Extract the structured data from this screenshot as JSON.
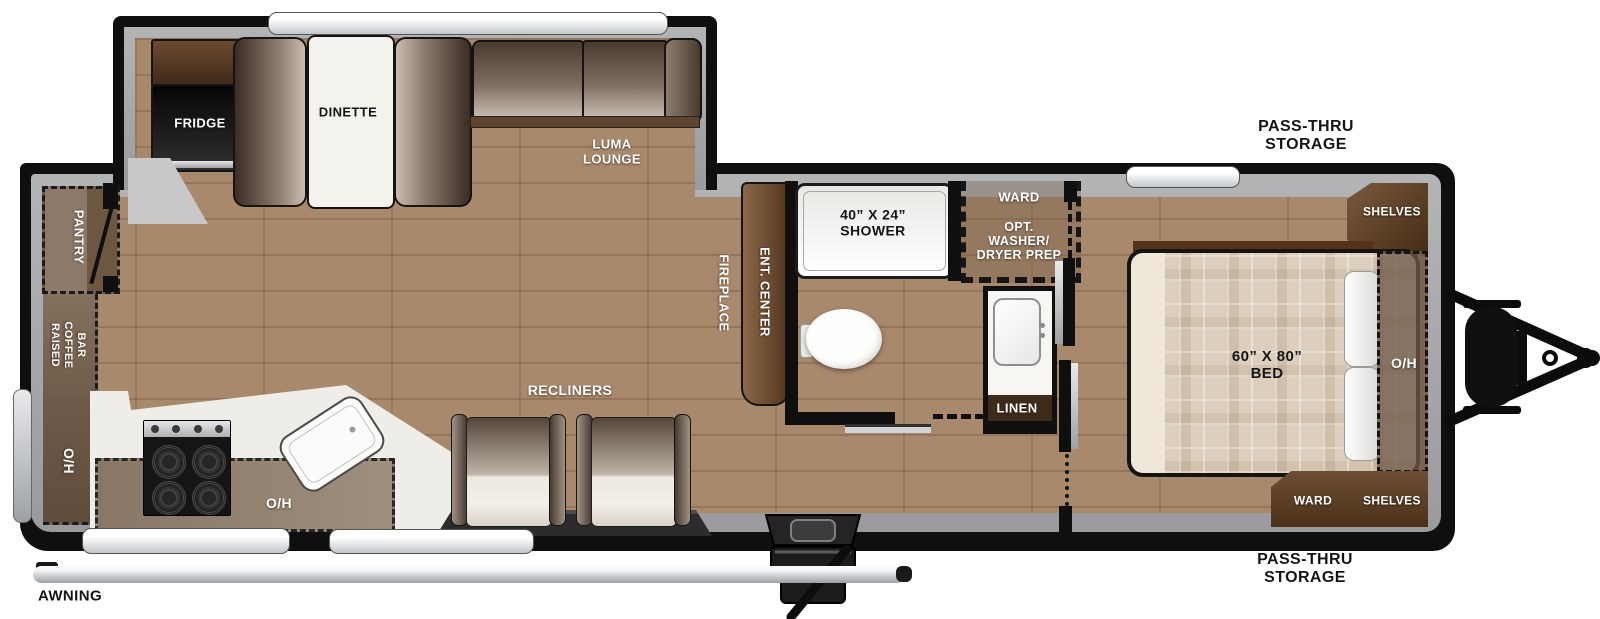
{
  "title": "Travel trailer floor plan",
  "colors": {
    "wall": "#0f0f0f",
    "floor_wood": "#a9896c",
    "wall_liner_gray": "#a7a9ac",
    "cabinet_brown": "#6e5740",
    "cabinet_dark_brown": "#4a3119",
    "counter_white": "#efede7",
    "overlay_brown": "#8b7360",
    "bed_plaid": "#dccfbd",
    "window_silver": "#c3c7ca"
  },
  "labels": {
    "fridge": "FRIDGE",
    "dinette": "DINETTE",
    "luma_line1": "LUMA",
    "luma_line2": "LOUNGE",
    "pantry": "PANTRY",
    "coffee_word1": "RAISED",
    "coffee_word2": "COFFEE",
    "coffee_word3": "BAR",
    "oh_left": "O/H",
    "oh_kitchen": "O/H",
    "recliners": "RECLINERS",
    "fireplace": "FIREPLACE",
    "ent_center": "ENT. CENTER",
    "shower_line1": "40” X 24”",
    "shower_line2": "SHOWER",
    "ward_line1": "WARD",
    "ward_line2": "OPT.",
    "ward_line3": "WASHER/",
    "ward_line4": "DRYER PREP",
    "linen": "LINEN",
    "bed_line1": "60” X 80”",
    "bed_line2": "BED",
    "oh_bed": "O/H",
    "shelves_front": "SHELVES",
    "ward_rear": "WARD",
    "shelves_rear": "SHELVES",
    "passthru_top_line1": "PASS-THRU",
    "passthru_top_line2": "STORAGE",
    "passthru_bottom_line1": "PASS-THRU",
    "passthru_bottom_line2": "STORAGE",
    "awning": "AWNING"
  }
}
